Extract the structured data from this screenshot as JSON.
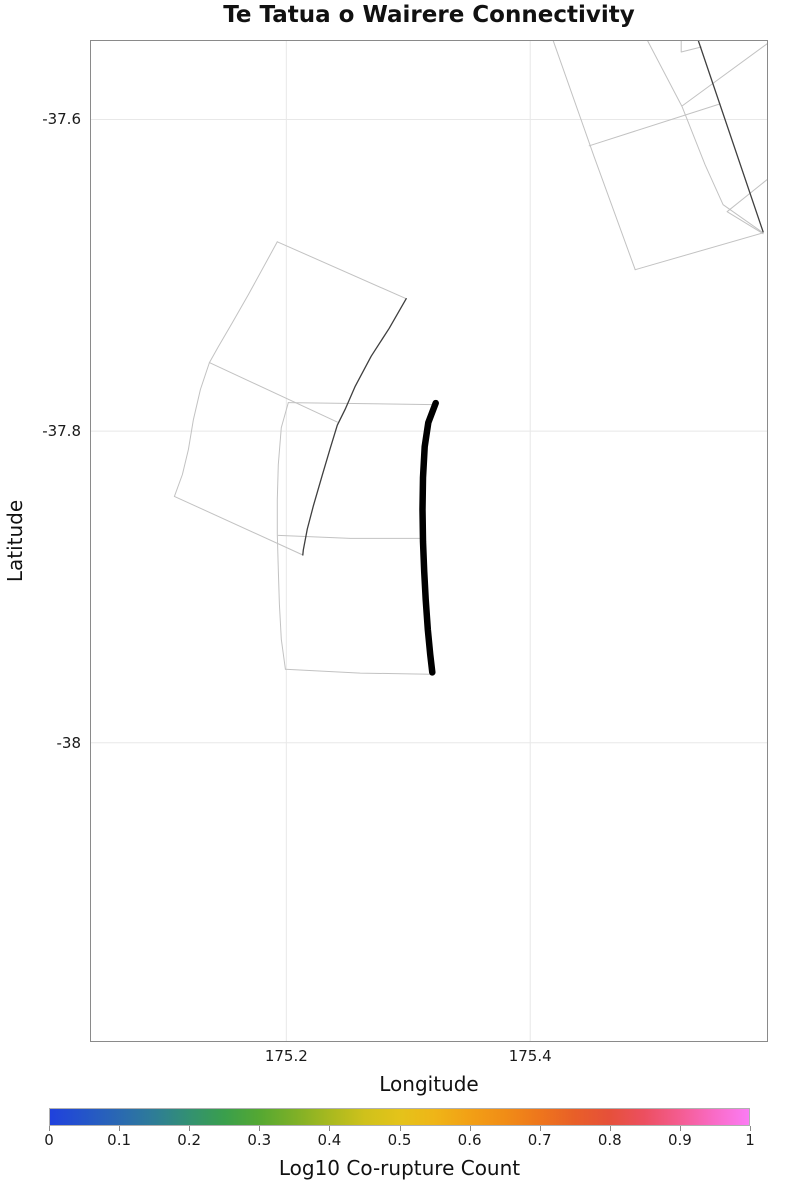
{
  "title": "Te Tatua o Wairere Connectivity",
  "axes": {
    "x_label": "Longitude",
    "y_label": "Latitude",
    "x_range": [
      175.039,
      175.595
    ],
    "y_range": [
      -38.192,
      -37.549
    ],
    "grid": true,
    "x_ticks": [
      {
        "value": 175.2,
        "label": "175.2"
      },
      {
        "value": 175.4,
        "label": "175.4"
      }
    ],
    "y_ticks": [
      {
        "value": -37.6,
        "label": "-37.6"
      },
      {
        "value": -37.8,
        "label": "-37.8"
      },
      {
        "value": -38.0,
        "label": "-38"
      }
    ]
  },
  "colors": {
    "grid": "#e8e8e8",
    "border": "#8a8a8a",
    "trace_light": "#c2c2c2",
    "trace_dark": "#3f3f3f",
    "trace_target": "#000000"
  },
  "colorbar": {
    "label": "Log10 Co-rupture Count",
    "min": 0,
    "max": 1,
    "tick_labels": [
      "0",
      "0.1",
      "0.2",
      "0.3",
      "0.4",
      "0.5",
      "0.6",
      "0.7",
      "0.8",
      "0.9",
      "1"
    ],
    "colormap_stops": [
      [
        0.0,
        "#2041dd"
      ],
      [
        0.05,
        "#2455c9"
      ],
      [
        0.1,
        "#2a69b1"
      ],
      [
        0.15,
        "#2e7d96"
      ],
      [
        0.2,
        "#339171"
      ],
      [
        0.25,
        "#3a9f4c"
      ],
      [
        0.3,
        "#55a832"
      ],
      [
        0.35,
        "#7db027"
      ],
      [
        0.4,
        "#a8b91f"
      ],
      [
        0.45,
        "#cfc11b"
      ],
      [
        0.5,
        "#e4c31a"
      ],
      [
        0.55,
        "#efb517"
      ],
      [
        0.6,
        "#f2a015"
      ],
      [
        0.65,
        "#f18d16"
      ],
      [
        0.7,
        "#ee761c"
      ],
      [
        0.75,
        "#e85f28"
      ],
      [
        0.8,
        "#e6503a"
      ],
      [
        0.85,
        "#ec4f60"
      ],
      [
        0.9,
        "#f45c90"
      ],
      [
        0.95,
        "#f96bc6"
      ],
      [
        1.0,
        "#fb7cf4"
      ]
    ]
  },
  "chart_data": {
    "type": "line",
    "subtype": "map-fault-traces",
    "title": "Te Tatua o Wairere Connectivity",
    "xlabel": "Longitude",
    "ylabel": "Latitude",
    "xlim": [
      175.039,
      175.595
    ],
    "ylim": [
      -38.192,
      -37.549
    ],
    "legend": "none",
    "series": [
      {
        "name": "west-fan-top-edge",
        "style": "light",
        "points": [
          [
            175.1926,
            -37.6785
          ],
          [
            175.2983,
            -37.715
          ]
        ]
      },
      {
        "name": "west-fan-west-edge",
        "style": "light",
        "points": [
          [
            175.1926,
            -37.6785
          ],
          [
            175.1688,
            -37.7125
          ],
          [
            175.1557,
            -37.7304
          ],
          [
            175.1442,
            -37.7458
          ],
          [
            175.1369,
            -37.756
          ],
          [
            175.1295,
            -37.7733
          ],
          [
            175.1238,
            -37.7926
          ],
          [
            175.1197,
            -37.8118
          ],
          [
            175.1148,
            -37.8278
          ],
          [
            175.1082,
            -37.8419
          ]
        ]
      },
      {
        "name": "west-fan-south-edge",
        "style": "light",
        "points": [
          [
            175.1082,
            -37.8419
          ],
          [
            175.2135,
            -37.8795
          ]
        ]
      },
      {
        "name": "west-fan-divider",
        "style": "light",
        "points": [
          [
            175.1369,
            -37.756
          ],
          [
            175.2418,
            -37.7942
          ]
        ]
      },
      {
        "name": "central-section-top-edge",
        "style": "light",
        "points": [
          [
            175.2016,
            -37.7817
          ],
          [
            175.3205,
            -37.783
          ]
        ]
      },
      {
        "name": "central-section-west-edge",
        "style": "light",
        "points": [
          [
            175.2016,
            -37.7817
          ],
          [
            175.1959,
            -37.7977
          ],
          [
            175.1934,
            -37.8214
          ],
          [
            175.1926,
            -37.8438
          ],
          [
            175.1926,
            -37.8663
          ],
          [
            175.1934,
            -37.8887
          ],
          [
            175.1943,
            -37.9112
          ],
          [
            175.1959,
            -37.9336
          ],
          [
            175.1992,
            -37.9528
          ]
        ]
      },
      {
        "name": "central-section-south-edge",
        "style": "light",
        "points": [
          [
            175.1992,
            -37.9528
          ],
          [
            175.2606,
            -37.9553
          ],
          [
            175.318,
            -37.956
          ]
        ]
      },
      {
        "name": "central-section-divider",
        "style": "light",
        "points": [
          [
            175.1934,
            -37.8669
          ],
          [
            175.2525,
            -37.8688
          ],
          [
            175.3123,
            -37.8688
          ]
        ]
      },
      {
        "name": "northeast-fault-west-edge",
        "style": "light",
        "points": [
          [
            175.4189,
            -37.5496
          ],
          [
            175.4525,
            -37.624
          ],
          [
            175.4861,
            -37.6964
          ]
        ]
      },
      {
        "name": "northeast-fault-south-edge",
        "style": "light",
        "points": [
          [
            175.4861,
            -37.6964
          ],
          [
            175.591,
            -37.6727
          ]
        ]
      },
      {
        "name": "northeast-fault-inner-edge",
        "style": "light",
        "points": [
          [
            175.4959,
            -37.549
          ],
          [
            175.5246,
            -37.5919
          ],
          [
            175.5434,
            -37.6291
          ],
          [
            175.5582,
            -37.6547
          ],
          [
            175.591,
            -37.6727
          ]
        ]
      },
      {
        "name": "northeast-fault-upper-cross-edge",
        "style": "light",
        "points": [
          [
            175.5246,
            -37.5913
          ],
          [
            175.5951,
            -37.5509
          ]
        ]
      },
      {
        "name": "northeast-fault-lower-cross-edge",
        "style": "light",
        "points": [
          [
            175.4484,
            -37.6169
          ],
          [
            175.5557,
            -37.59
          ]
        ]
      },
      {
        "name": "northeast-fault-notch-edge",
        "style": "light",
        "points": [
          [
            175.5238,
            -37.549
          ],
          [
            175.5238,
            -37.5567
          ],
          [
            175.5402,
            -37.5535
          ]
        ]
      },
      {
        "name": "northeast-fault-east-notch-edge",
        "style": "light",
        "points": [
          [
            175.5951,
            -37.6381
          ],
          [
            175.5615,
            -37.6592
          ],
          [
            175.591,
            -37.6733
          ]
        ]
      },
      {
        "name": "co-rupture-trace-west",
        "style": "dark",
        "points": [
          [
            175.2983,
            -37.715
          ],
          [
            175.2844,
            -37.734
          ],
          [
            175.2696,
            -37.7519
          ],
          [
            175.2565,
            -37.7712
          ],
          [
            175.2483,
            -37.7859
          ],
          [
            175.2418,
            -37.7962
          ],
          [
            175.2361,
            -37.8109
          ],
          [
            175.2295,
            -37.8282
          ],
          [
            175.2221,
            -37.8481
          ],
          [
            175.2172,
            -37.8628
          ],
          [
            175.2139,
            -37.8763
          ],
          [
            175.2135,
            -37.8795
          ]
        ]
      },
      {
        "name": "co-rupture-trace-northeast",
        "style": "dark",
        "points": [
          [
            175.5377,
            -37.549
          ],
          [
            175.591,
            -37.6721
          ]
        ]
      },
      {
        "name": "te-tatua-o-wairere-fault-trace",
        "style": "target",
        "points": [
          [
            175.3225,
            -37.782
          ],
          [
            175.3164,
            -37.7945
          ],
          [
            175.3135,
            -37.8099
          ],
          [
            175.3121,
            -37.8298
          ],
          [
            175.3117,
            -37.8503
          ],
          [
            175.3121,
            -37.8708
          ],
          [
            175.3131,
            -37.89
          ],
          [
            175.3143,
            -37.908
          ],
          [
            175.316,
            -37.9272
          ],
          [
            175.318,
            -37.9432
          ],
          [
            175.3197,
            -37.9548
          ]
        ]
      }
    ]
  }
}
